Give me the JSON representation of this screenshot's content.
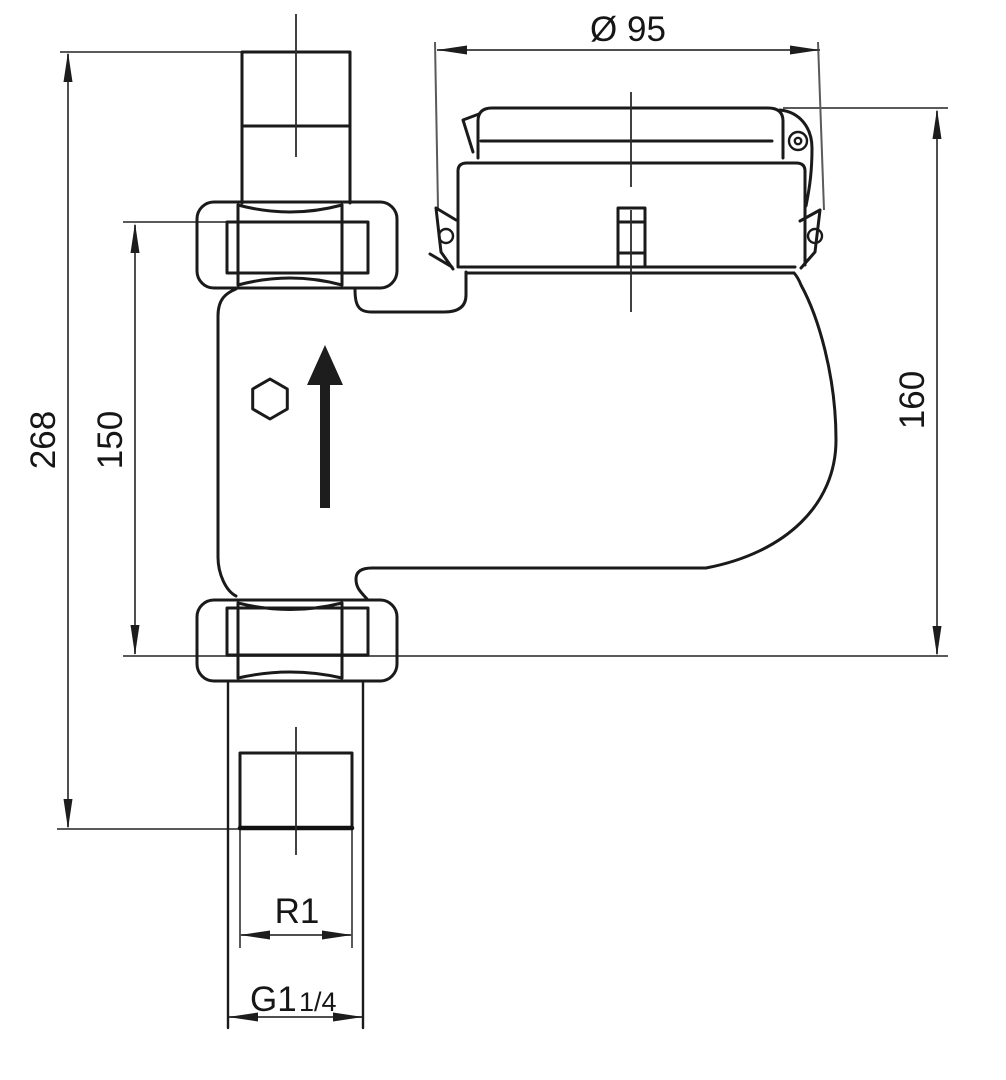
{
  "drawing": {
    "background": "#ffffff",
    "object_line_color": "#1a1a1a",
    "dimension_line_color": "#4f4f4f"
  },
  "dimensions": {
    "head_diameter": {
      "label": "Ø 95"
    },
    "overall_height": {
      "label": "268"
    },
    "connection_spacing": {
      "label": "150"
    },
    "meter_height": {
      "label": "160"
    },
    "tail_thread": {
      "label": "R1"
    },
    "union_thread_main": {
      "label": "G1"
    },
    "union_thread_fraction": {
      "label": "1/4"
    }
  },
  "symbols": {
    "flow_direction": "up"
  }
}
